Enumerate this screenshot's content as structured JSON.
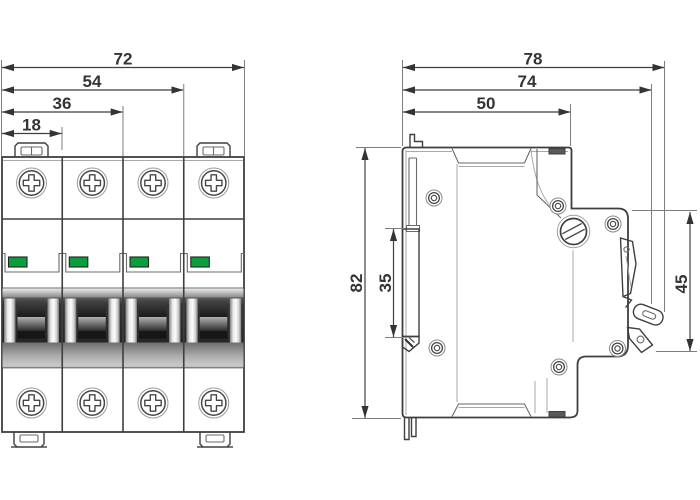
{
  "front_view": {
    "width_dimensions_mm": [
      {
        "value": "72"
      },
      {
        "value": "54"
      },
      {
        "value": "36"
      },
      {
        "value": "18"
      }
    ],
    "poles": 4
  },
  "side_view": {
    "depth_dimensions_mm": [
      {
        "value": "78"
      },
      {
        "value": "74"
      },
      {
        "value": "50"
      }
    ],
    "height_dimensions_mm": [
      {
        "value": "82"
      },
      {
        "value": "35"
      },
      {
        "value": "45"
      }
    ]
  },
  "colors": {
    "outline": "#3f3f3f",
    "dim_text": "#343434",
    "indicator_green": "#0b9e3d",
    "band_dark": "#2e2e2e"
  }
}
